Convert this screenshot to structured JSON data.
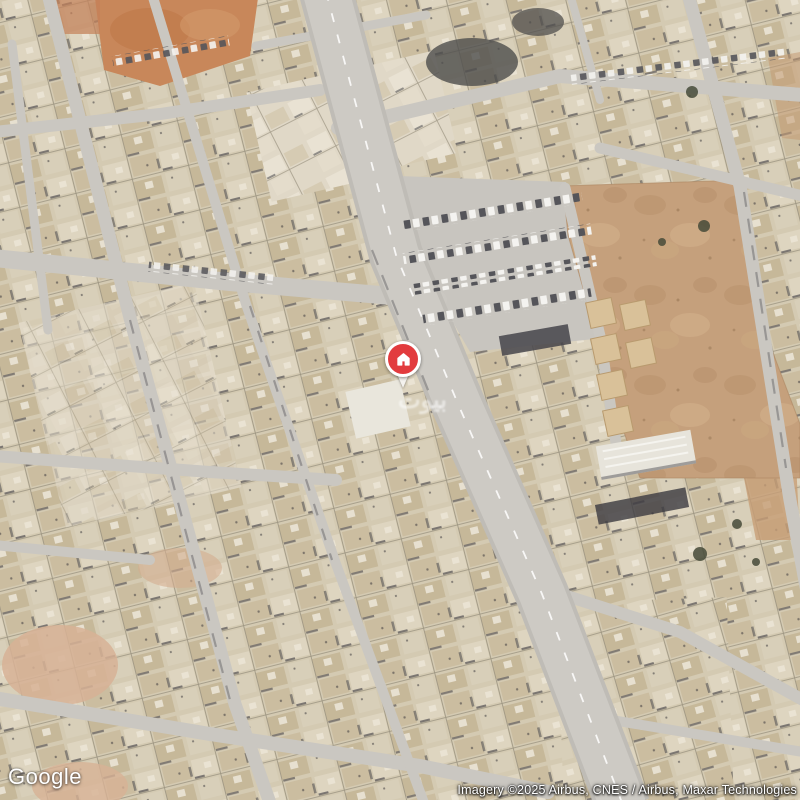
{
  "map": {
    "view_type": "satellite",
    "logo_text": "Google",
    "attribution_text": "Imagery ©2025 Airbus, CNES / Airbus, Maxar Technologies",
    "watermark_text": "بيوت",
    "marker": {
      "kind": "property-location-pin",
      "icon": "house-icon"
    },
    "css_colors": {
      "pin": "#e23b3e",
      "ring": "#ffffff",
      "icon": "#ffffff"
    },
    "palette_reference": {
      "road_gray": "#c9c6c0",
      "city_block_tan": "#d4cab2",
      "dirt_lot_brown": "#c5a07c",
      "orange_sand": "#c8875a",
      "building_shadow": "#3c3b41"
    }
  }
}
